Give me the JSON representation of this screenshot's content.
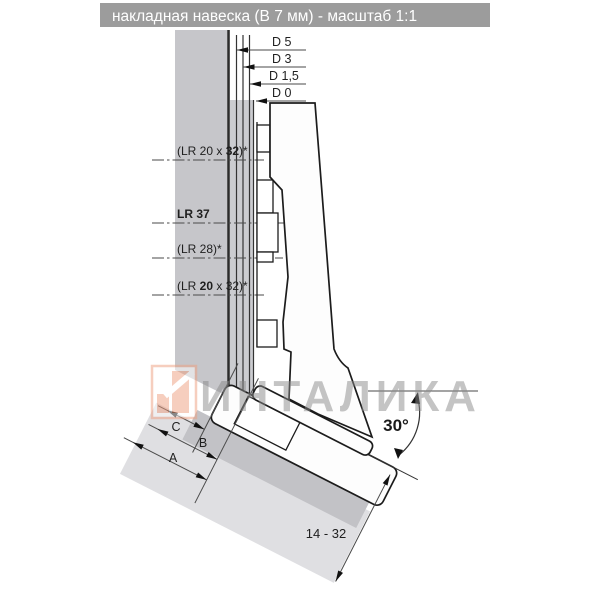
{
  "title": "накладная навеска (В 7 мм) - масштаб 1:1",
  "top_dims": {
    "d5": "D 5",
    "d3": "D 3",
    "d15": "D 1,5",
    "d0": "D 0"
  },
  "lr_dims": {
    "row1": {
      "pre": "(LR 20 x ",
      "bold": "32",
      "post": ")*"
    },
    "row2": {
      "pre": "",
      "bold": "LR 37",
      "post": ""
    },
    "row3": {
      "pre": "(LR 28)*",
      "bold": "",
      "post": ""
    },
    "row4": {
      "pre": "(LR ",
      "bold": "20",
      "post": " x 32)*"
    }
  },
  "bottom_dims": {
    "c": "C",
    "b": "B",
    "a": "A",
    "range": "14 - 32",
    "angle": "30°"
  },
  "watermark": {
    "text": "ИНТАЛИКА"
  },
  "colors": {
    "title_bar": "#9c9c9c",
    "panel_gray": "#c6c6ca",
    "door_section_gray": "#cbccd0",
    "shadow_medium": "#c2c2c6",
    "shadow_light": "#dfdfe2",
    "line_dark": "#1c1c1c",
    "watermark_gray": "#8a8a8a",
    "logo_salmon": "#ef9f7f"
  }
}
